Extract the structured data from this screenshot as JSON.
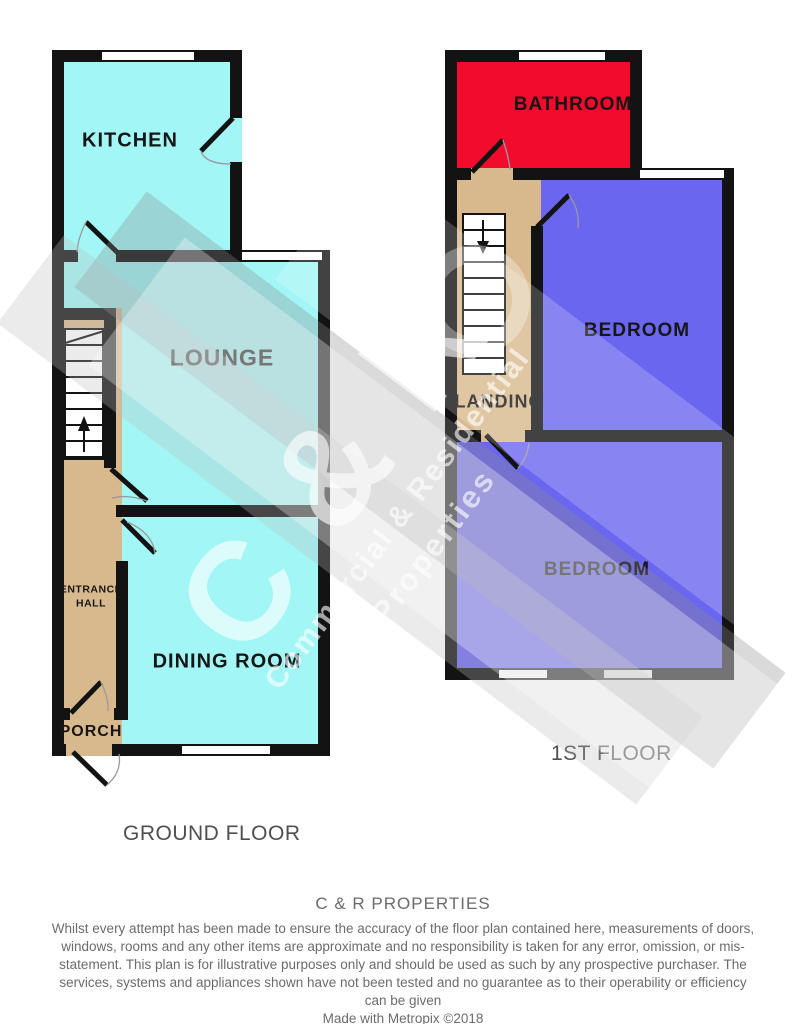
{
  "ground_floor": {
    "label": "GROUND FLOOR",
    "rooms": {
      "kitchen": "KITCHEN",
      "lounge": "LOUNGE",
      "entrance_hall": "ENTRANCE HALL",
      "dining_room": "DINING ROOM",
      "porch": "PORCH"
    }
  },
  "first_floor": {
    "label": "1ST FLOOR",
    "rooms": {
      "bathroom": "BATHROOM",
      "landing": "LANDING",
      "bedroom_front": "BEDROOM",
      "bedroom_rear": "BEDROOM"
    }
  },
  "watermark": {
    "brand": "C & R",
    "tagline_line1": "Commercial & Residential",
    "tagline_line2": "Properties"
  },
  "footer": {
    "company": "C & R PROPERTIES",
    "disclaimer": "Whilst every attempt has been made to ensure the accuracy of the floor plan contained here, measurements of doors, windows, rooms and any other items are approximate and no responsibility is taken for any error, omission, or mis-statement. This plan is for illustrative purposes only and should be used as such by any prospective purchaser. The services, systems and appliances shown have not been tested and no guarantee as to their operability or efficiency can be given",
    "credit": "Made with Metropix ©2018"
  },
  "colors": {
    "room_cyan": "#a2f6f6",
    "room_blue": "#6b66ef",
    "room_red": "#f30b2e",
    "hall_tan": "#d8b98e",
    "wall_black": "#131313",
    "label_gray": "#4f4f4f",
    "footer_gray": "#6b6b6b"
  }
}
